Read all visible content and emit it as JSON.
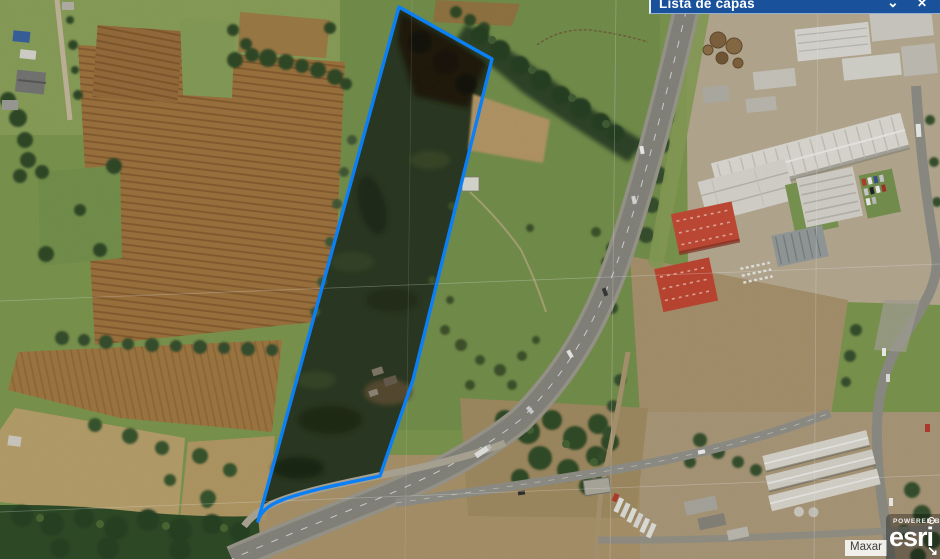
{
  "layer_panel": {
    "title": "Lista de capas",
    "collapse_icon": "⌄",
    "close_icon": "✕"
  },
  "attribution": {
    "label": "Maxar"
  },
  "logo": {
    "powered_by": "POWERED BY",
    "brand": "esri",
    "expand_arrow": "↘"
  },
  "parcel": {
    "path": "M399,7 L492,59 L413,380 L380,476 C346,483 309,490 282,500 C269,505 261,511 258,521 Z",
    "stroke_color": "#0b80f6",
    "fill_color": "#2e3d25"
  },
  "colors": {
    "panel_blue": "#19529a",
    "parcel_blue": "#0b80f6"
  }
}
